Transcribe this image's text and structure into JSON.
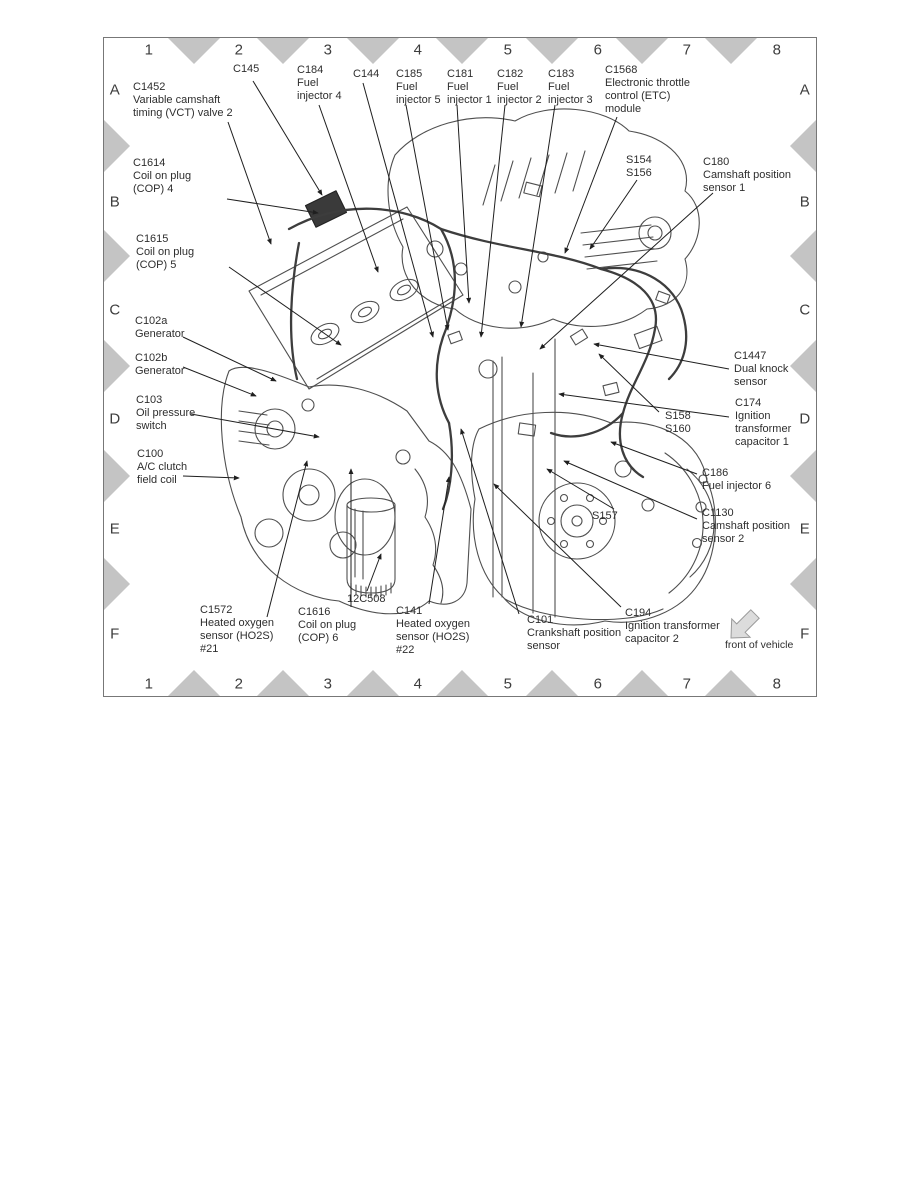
{
  "grid": {
    "columns": [
      "1",
      "2",
      "3",
      "4",
      "5",
      "6",
      "7",
      "8"
    ],
    "rows": [
      "A",
      "B",
      "C",
      "D",
      "E",
      "F"
    ]
  },
  "front_of_vehicle_label": "front of vehicle",
  "colors": {
    "triangle": "#c4c4c4",
    "leader_line": "#1f1f1f",
    "text": "#2e2e2e",
    "border": "#777777"
  },
  "callouts": [
    {
      "id": "C1452",
      "desc": "Variable camshaft timing (VCT) valve 2"
    },
    {
      "id": "C145",
      "desc": ""
    },
    {
      "id": "C184",
      "desc": "Fuel injector 4"
    },
    {
      "id": "C144",
      "desc": ""
    },
    {
      "id": "C185",
      "desc": "Fuel injector 5"
    },
    {
      "id": "C181",
      "desc": "Fuel injector 1"
    },
    {
      "id": "C182",
      "desc": "Fuel injector 2"
    },
    {
      "id": "C183",
      "desc": "Fuel injector 3"
    },
    {
      "id": "C1568",
      "desc": "Electronic throttle control (ETC) module"
    },
    {
      "id": "S154\nS156",
      "desc": ""
    },
    {
      "id": "C180",
      "desc": "Camshaft position sensor 1"
    },
    {
      "id": "C1614",
      "desc": "Coil on plug (COP) 4"
    },
    {
      "id": "C1615",
      "desc": "Coil on plug (COP) 5"
    },
    {
      "id": "C102a",
      "desc": "Generator"
    },
    {
      "id": "C102b",
      "desc": "Generator"
    },
    {
      "id": "C103",
      "desc": "Oil pressure switch"
    },
    {
      "id": "C100",
      "desc": "A/C clutch field coil"
    },
    {
      "id": "C1447",
      "desc": "Dual knock sensor"
    },
    {
      "id": "C174",
      "desc": "Ignition transformer capacitor 1"
    },
    {
      "id": "S158\nS160",
      "desc": ""
    },
    {
      "id": "C186",
      "desc": "Fuel injector 6"
    },
    {
      "id": "S157",
      "desc": ""
    },
    {
      "id": "C1130",
      "desc": "Camshaft position sensor 2"
    },
    {
      "id": "12C508",
      "desc": ""
    },
    {
      "id": "C1572",
      "desc": "Heated oxygen sensor (HO2S) #21"
    },
    {
      "id": "C1616",
      "desc": "Coil on plug (COP) 6"
    },
    {
      "id": "C141",
      "desc": "Heated oxygen sensor (HO2S) #22"
    },
    {
      "id": "C101",
      "desc": "Crankshaft position sensor"
    },
    {
      "id": "C194",
      "desc": "Ignition transformer capacitor 2"
    }
  ]
}
